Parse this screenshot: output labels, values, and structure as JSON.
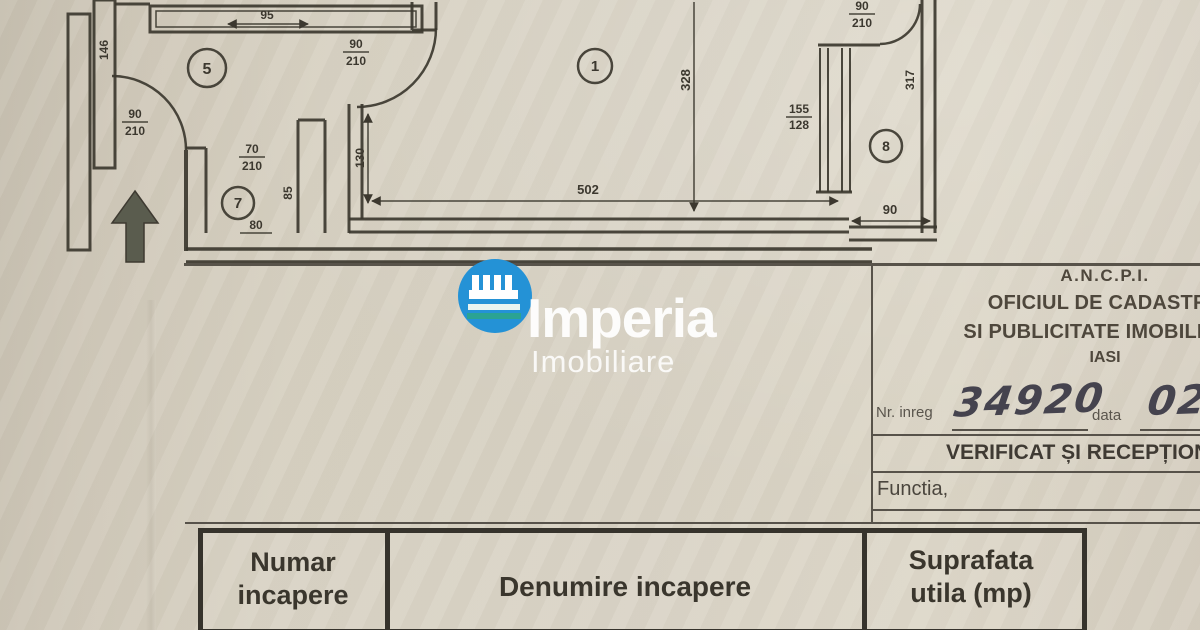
{
  "colors": {
    "logo_blue": "#2492d6",
    "logo_teal": "#2ba393",
    "ink": "#3c382f",
    "paper": "#d7d1c2"
  },
  "plan": {
    "rooms": {
      "hall": "5",
      "room1": "1",
      "room7": "7",
      "room8": "8"
    },
    "dims": {
      "top_window": "95",
      "left_window": "146",
      "entry_height": "130",
      "room1_width": "502",
      "room1_height": "328",
      "room8_height": "317",
      "room8_width": "90",
      "niche_height": "85",
      "niche_width": "80",
      "partition_top": "155",
      "partition_bottom": "128"
    },
    "doors": {
      "left": {
        "w": "90",
        "h": "210"
      },
      "top": {
        "w": "90",
        "h": "210"
      },
      "room7": {
        "w": "70",
        "h": "210"
      },
      "room8": {
        "w": "90",
        "h": "210"
      }
    }
  },
  "watermark": {
    "brand": "Imperia",
    "subtitle": "Imobiliare"
  },
  "stamp": {
    "agency": "A.N.C.P.I.",
    "office_line1": "OFICIUL DE CADASTRU",
    "office_line2": "SI PUBLICITATE IMOBILIARA",
    "city": "IASI",
    "nr_label": "Nr. inreg",
    "nr_value": "34920",
    "date_label": "data",
    "date_value": "02",
    "verified": "VERIFICAT ȘI RECEPȚIONAT",
    "functia": "Functia,"
  },
  "table": {
    "col1": {
      "line1": "Numar",
      "line2": "incapere"
    },
    "col2": {
      "line1": "Denumire incapere"
    },
    "col3": {
      "line1": "Suprafata",
      "line2": "utila (mp)"
    }
  }
}
